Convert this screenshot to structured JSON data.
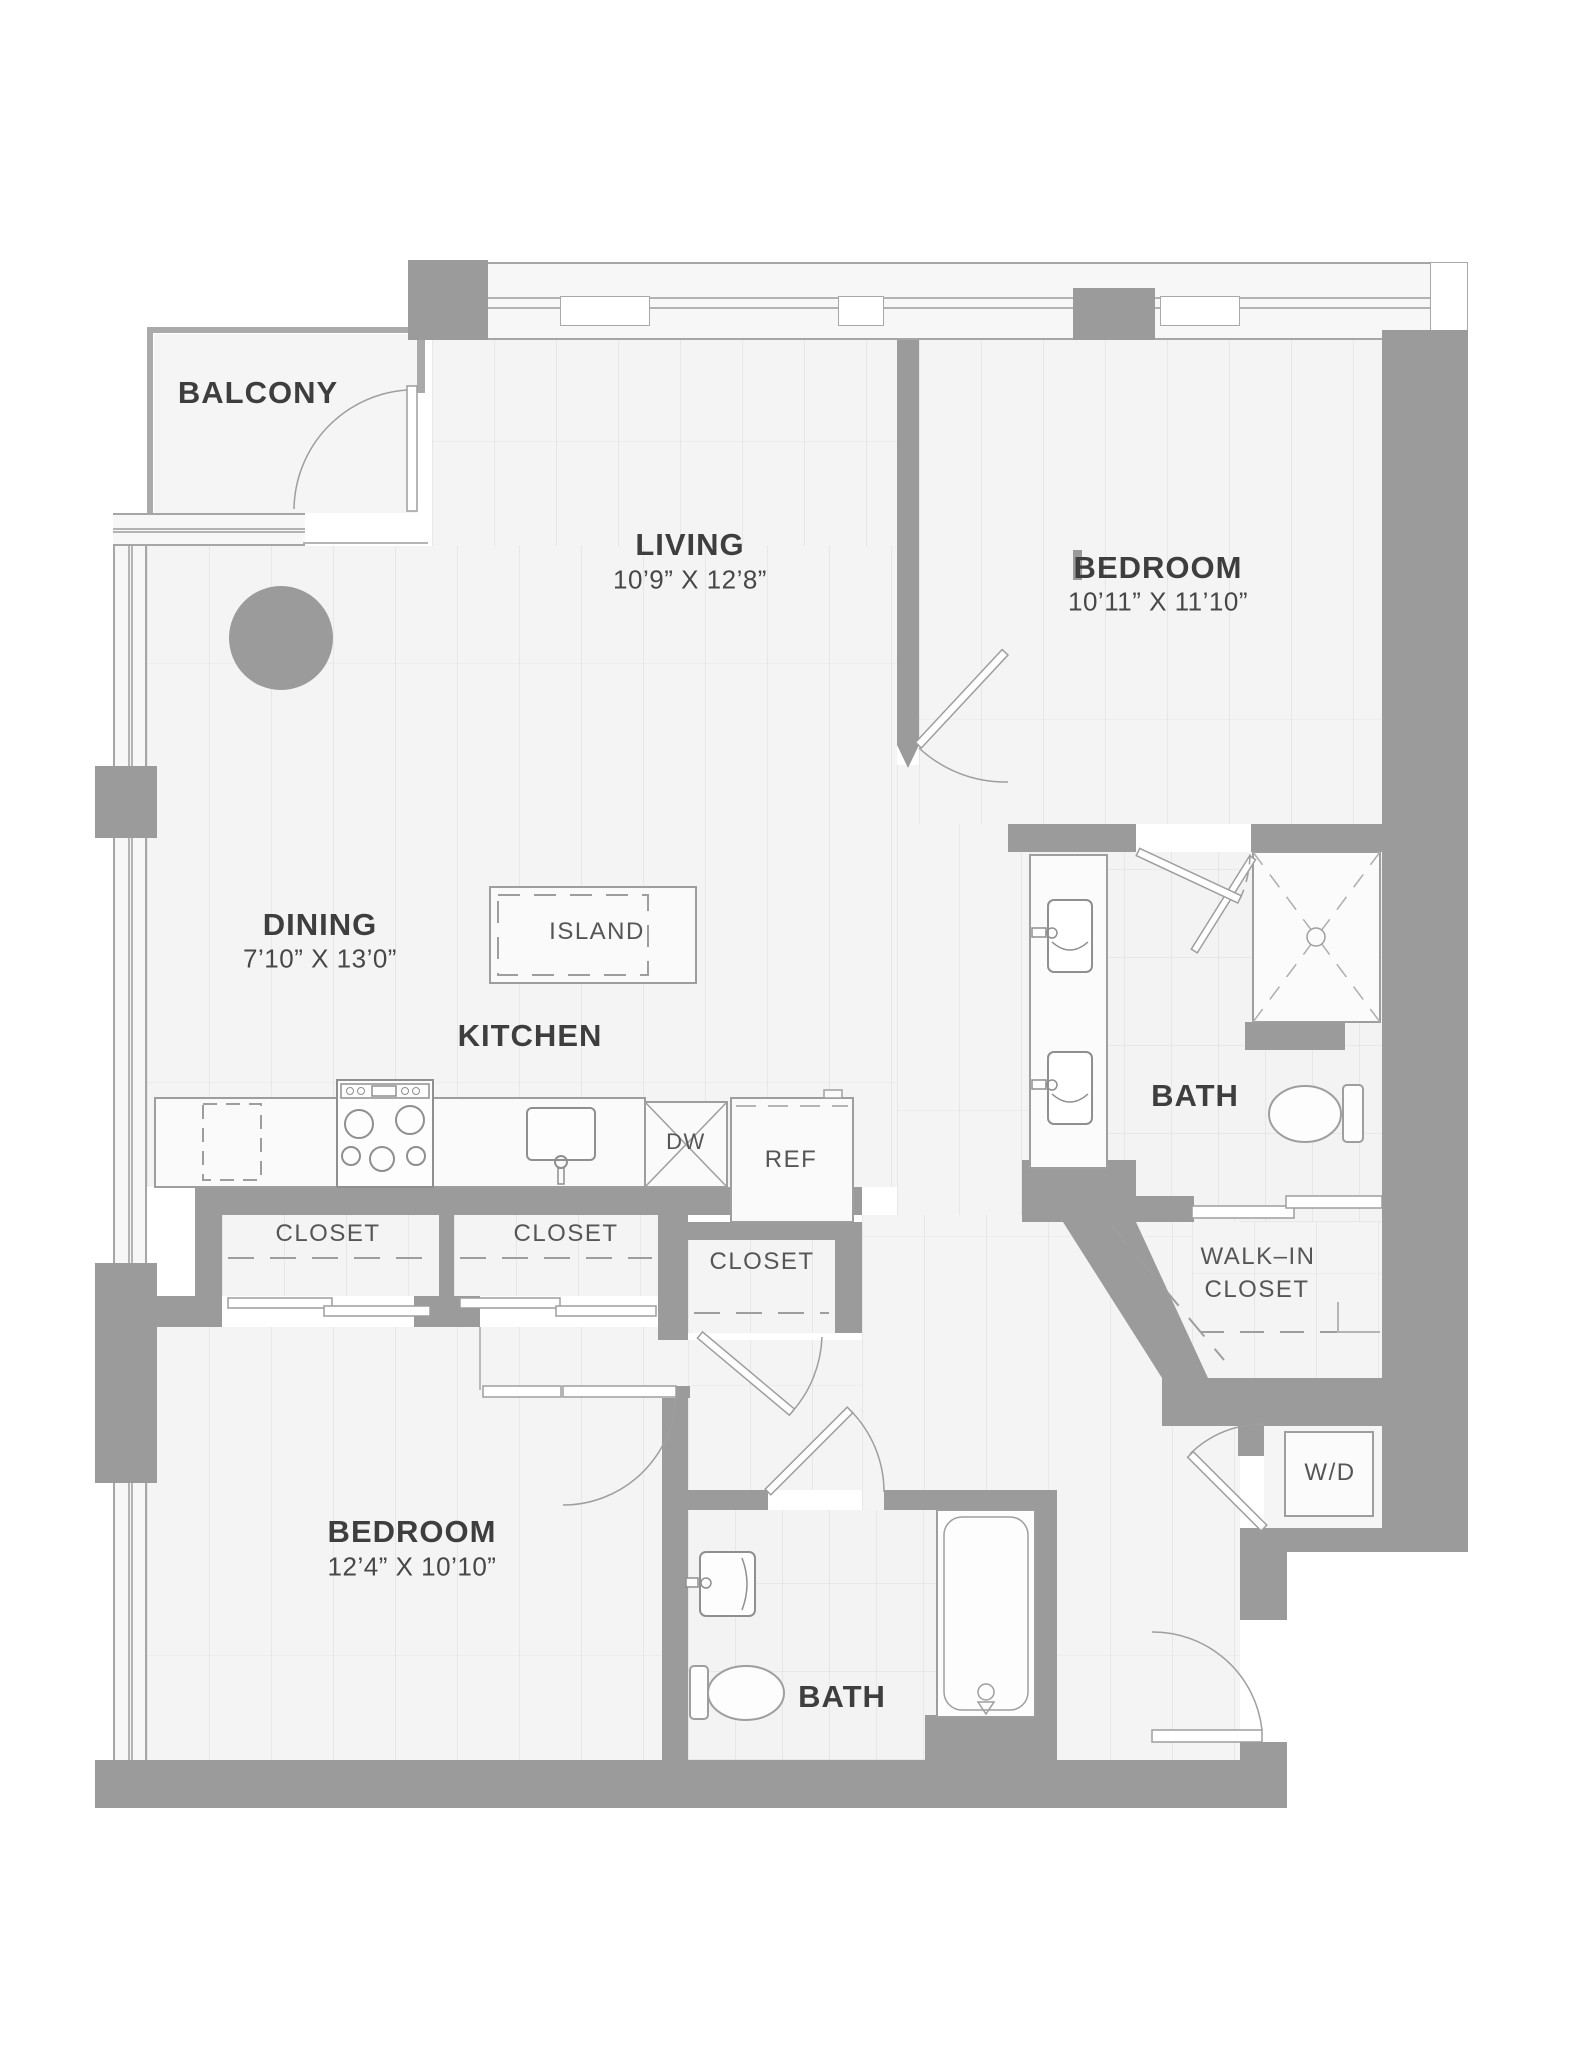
{
  "colors": {
    "wall": "#9b9b9b",
    "floor": "#f4f4f4",
    "outline": "#9e9e9e",
    "label_dark": "#3e3e3e",
    "label_dim": "#474747",
    "label_fixture": "#565656"
  },
  "rooms": {
    "balcony": {
      "label": "BALCONY"
    },
    "living": {
      "label": "LIVING",
      "dims": "10’9” X 12’8”"
    },
    "bedroom1": {
      "label": "BEDROOM",
      "dims": "10’11” X 11’10”"
    },
    "dining": {
      "label": "DINING",
      "dims": "7’10” X 13’0”"
    },
    "kitchen": {
      "label": "KITCHEN"
    },
    "bath1": {
      "label": "BATH"
    },
    "walk_in": {
      "line1": "WALK–IN",
      "line2": "CLOSET"
    },
    "bath2": {
      "label": "BATH"
    },
    "bedroom2": {
      "label": "BEDROOM",
      "dims": "12’4” X 10’10”"
    }
  },
  "fixtures": {
    "island": {
      "label": "ISLAND"
    },
    "dishwasher": {
      "label": "DW"
    },
    "refrigerator": {
      "label": "REF"
    },
    "washer_dryer": {
      "label": "W/D"
    },
    "closet1": {
      "label": "CLOSET"
    },
    "closet2": {
      "label": "CLOSET"
    },
    "closet3": {
      "label": "CLOSET"
    }
  }
}
